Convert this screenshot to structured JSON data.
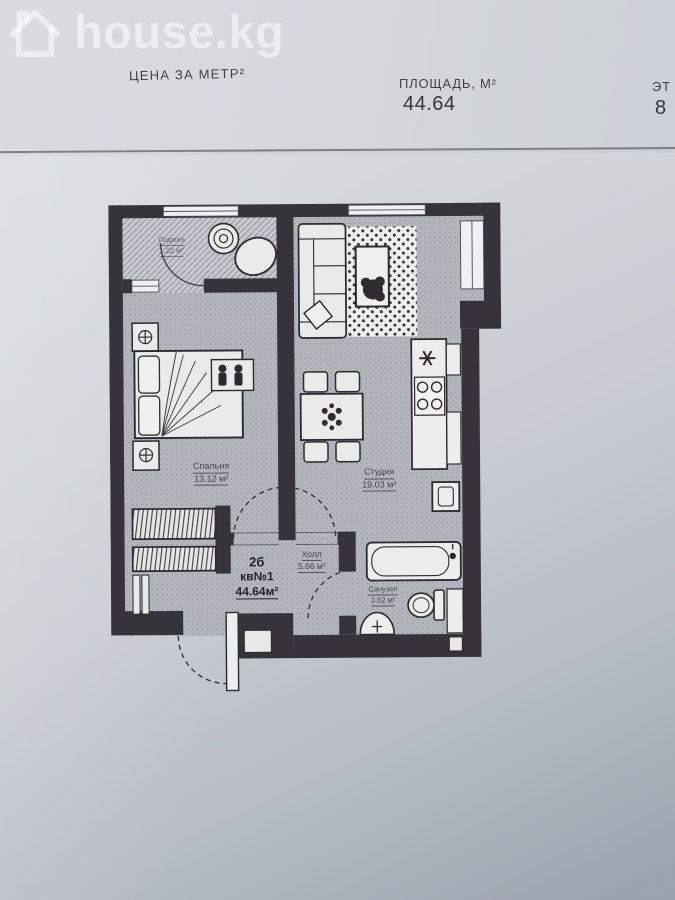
{
  "watermark": {
    "brand": "house.kg",
    "icon": "house-icon"
  },
  "header": {
    "price_label": "ЦЕНА ЗА МЕТР²",
    "area_label": "ПЛОЩАДЬ, М²",
    "area_value": "44.64",
    "floor_label": "ЭТ",
    "floor_value": "8"
  },
  "plan": {
    "apartment": {
      "type": "2б",
      "unit": "кв№1",
      "area": "44.64м²"
    },
    "rooms": {
      "loggia": {
        "name": "Лоджия",
        "area": "1.22 м²"
      },
      "bedroom": {
        "name": "Спальня",
        "area": "13.12 м²"
      },
      "studio": {
        "name": "Студия",
        "area": "19.03 м²"
      },
      "hall": {
        "name": "Холл",
        "area": "5.66 м²"
      },
      "bathroom": {
        "name": "Санузел",
        "area": "3.62 м²"
      }
    },
    "colors": {
      "wall": "#36333a",
      "floor": "#b4b7bd",
      "paper": "#cdd1d7",
      "rug": "#eff0ed"
    }
  }
}
